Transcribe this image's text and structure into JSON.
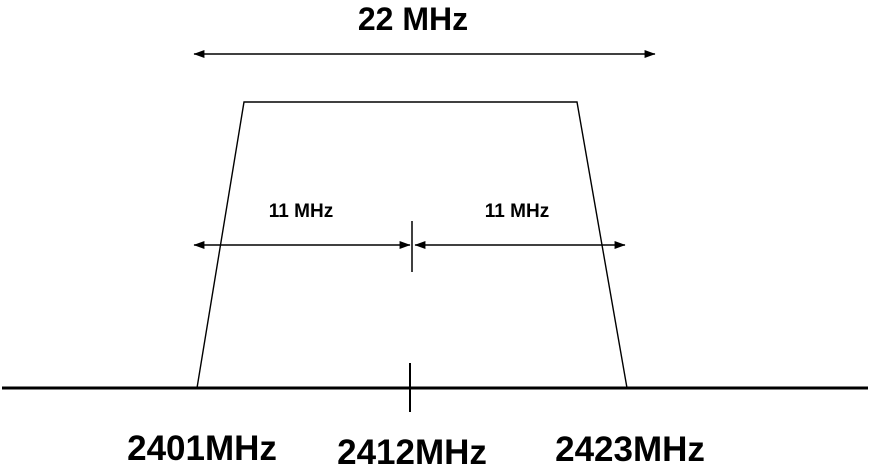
{
  "figure": {
    "total_bandwidth_label": "22 MHz",
    "left_half_bandwidth_label": "11 MHz",
    "right_half_bandwidth_label": "11 MHz",
    "frequency_labels": {
      "lower_edge": "2401MHz",
      "center": "2412MHz",
      "upper_edge": "2423MHz"
    },
    "colors": {
      "line": "#000000",
      "text": "#000000",
      "background": "#ffffff"
    }
  }
}
